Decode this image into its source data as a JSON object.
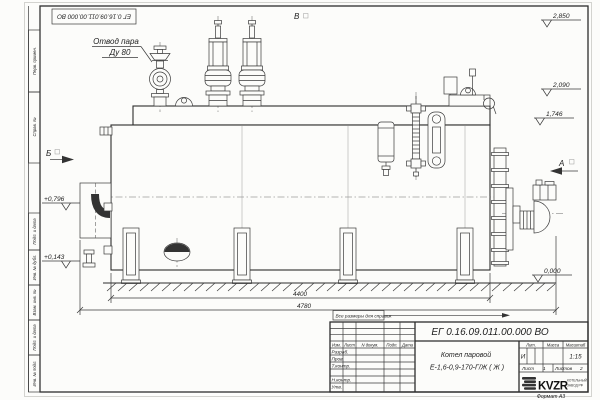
{
  "colors": {
    "paper": "#fcfcfa",
    "line": "#3a3a3a",
    "text": "#222222"
  },
  "stamp": {
    "doc_number": "ЕГ 0.16.09.011.00.000  ВО"
  },
  "callout": {
    "line1": "Отвод пара",
    "line2": "Ду 80"
  },
  "views": {
    "top": "В",
    "left": "Б",
    "right": "А"
  },
  "elevations": {
    "top": "2,850",
    "dome": "2,090",
    "deck": "1,746",
    "burner": "+0,796",
    "manhole": "+0,143",
    "ground": "0,000"
  },
  "dimensions": {
    "body_length": "4400",
    "overall_length": "4780"
  },
  "note": {
    "text": "Все размеры для справок"
  },
  "title_block": {
    "doc_number": "ЕГ 0.16.09.011.00.000  ВО",
    "product_name": "Котел паровой",
    "product_designation": "Е-1,6-0,9-170-Г/Ж ( Ж )",
    "col_izm": "Изм.",
    "col_list": "Лист",
    "col_ndoc": "N докум.",
    "col_podp": "Подп.",
    "col_data": "Дата",
    "row_razrab": "Разраб.",
    "row_prov": "Пров.",
    "row_tkontr": "Т.контр.",
    "row_nkontr": "Н.контр.",
    "row_utv": "Утв.",
    "lit_label": "Лит.",
    "mass_label": "Масса",
    "scale_label": "Масштаб",
    "lit_value": "И",
    "scale_value": "1:15",
    "sheet_label": "Лист",
    "sheet_number": "1",
    "sheets_label": "Листов",
    "sheets_total": "2",
    "logo_text": "KVZR",
    "logo_caption_line1": "КОТЕЛЬНЫЙ",
    "logo_caption_line2": "ЗАВОД РФ",
    "format_label": "Формат А3"
  },
  "margin_labels": [
    "Перв. примен.",
    "Справ. №",
    "Подп. и дата",
    "Инв. № дубл.",
    "Взам. инв. №",
    "Подп. и дата",
    "Инв. № подл."
  ]
}
